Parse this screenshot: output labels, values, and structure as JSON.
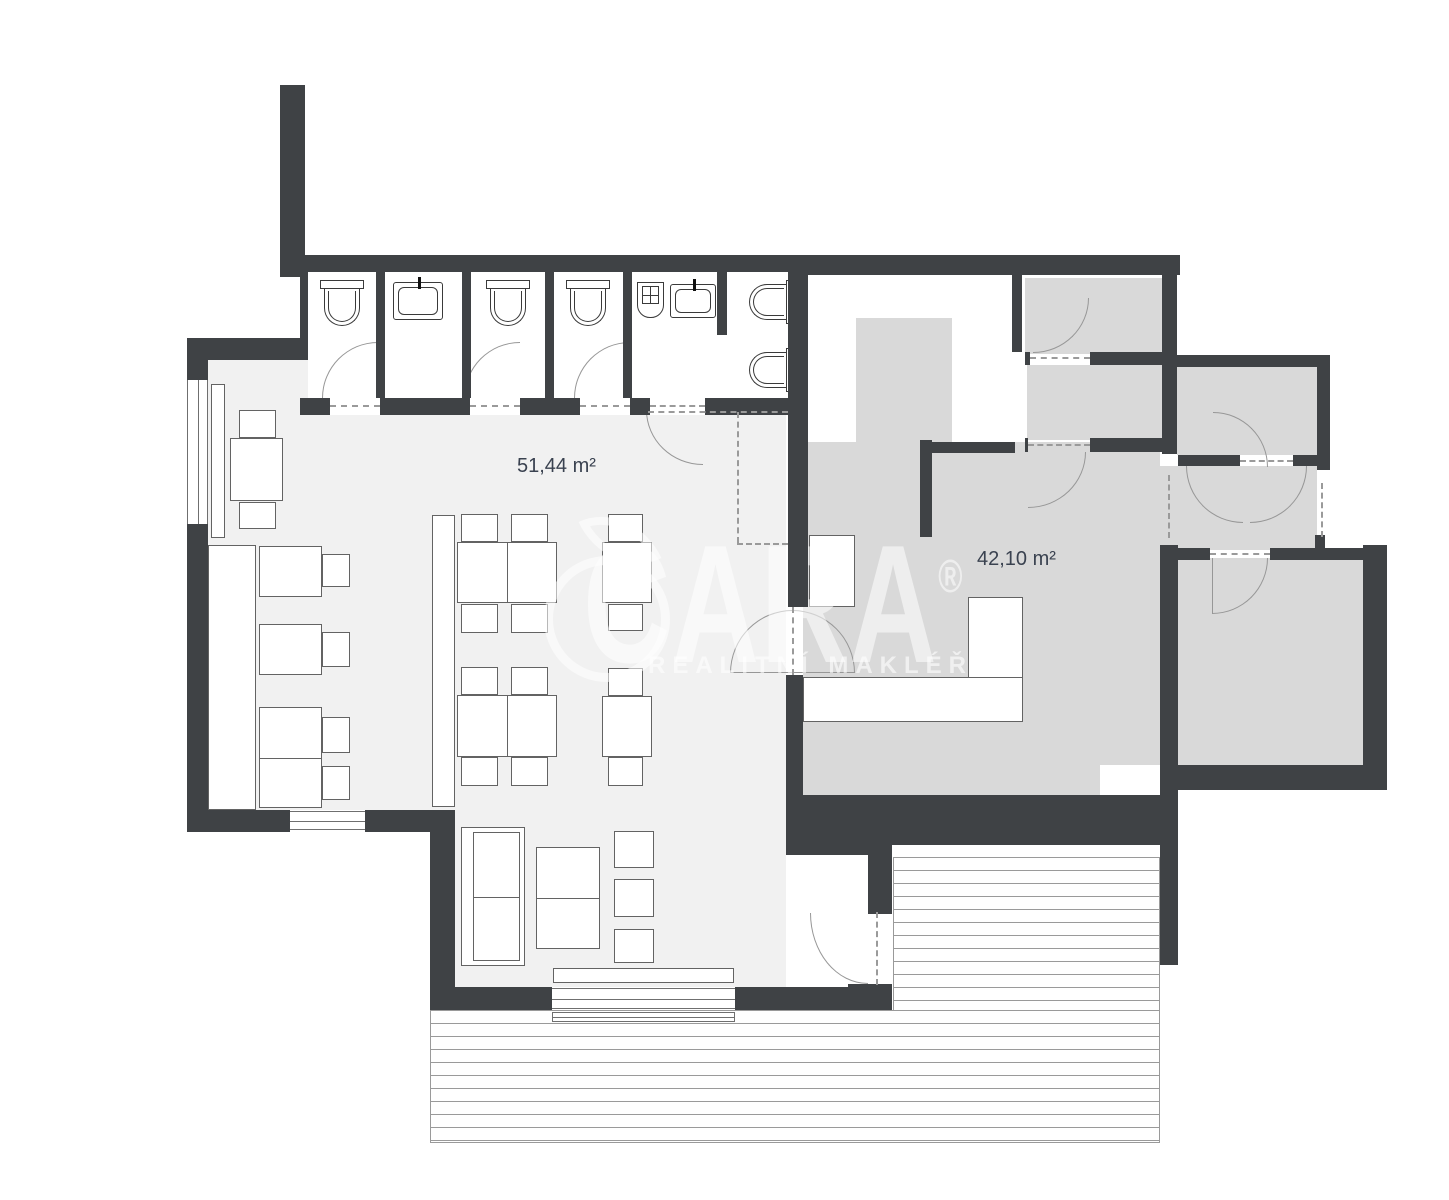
{
  "title": "Floor plan",
  "rooms": [
    {
      "id": "restaurant",
      "area_label": "51,44 m²"
    },
    {
      "id": "kitchen",
      "area_label": "42,10 m²"
    }
  ],
  "watermark": {
    "brand": "CARA",
    "registered": "®",
    "tagline": "REALITNÍ MAKLÉŘI"
  },
  "colors": {
    "wall": "#3f4245",
    "floor_light": "#f1f1f1",
    "floor_dark": "#d9d9d9",
    "label_text": "#3a4250",
    "line": "#979797",
    "watermark": "rgba(255,255,255,0.55)"
  }
}
